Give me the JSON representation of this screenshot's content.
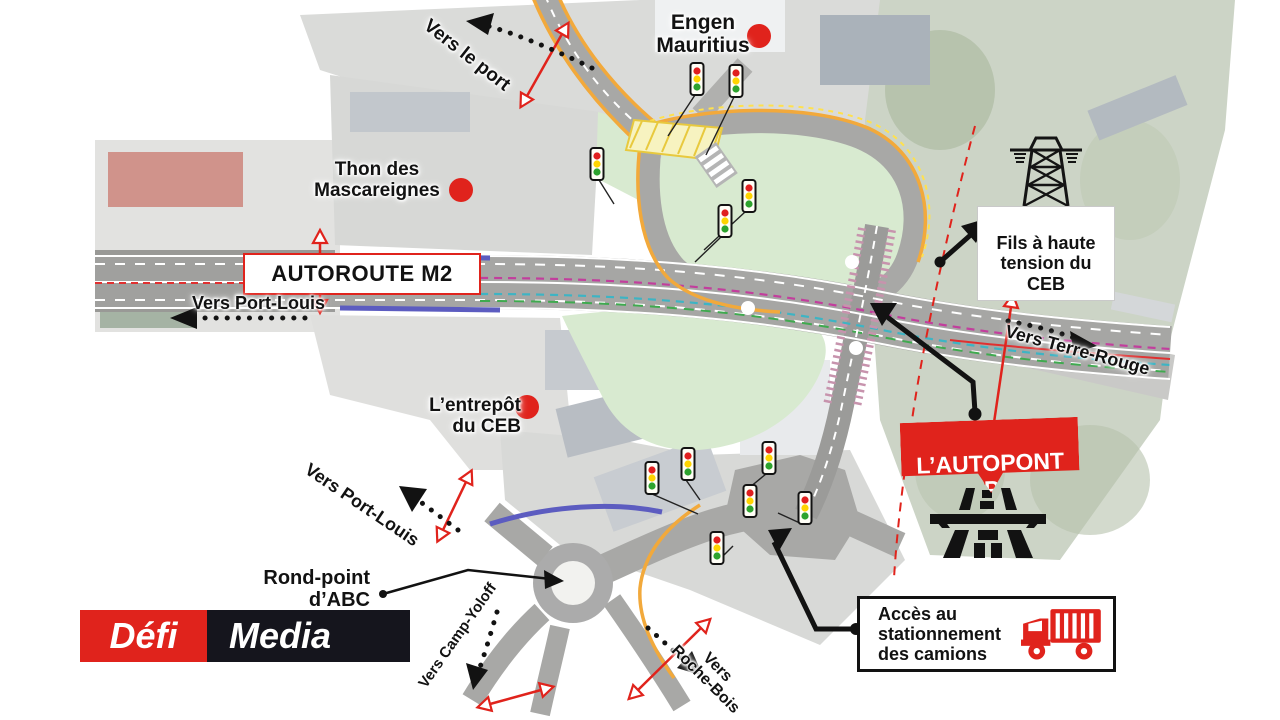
{
  "title": "Infographie de l'autopont proposé (échangeur autoroute M2)",
  "colors": {
    "accent_red": "#e0231c",
    "logo_dark": "#15151d",
    "road_gray": "#a6a6a4",
    "green_area": "#d8ead0",
    "orange_edge": "#f2a93b",
    "blue_edge": "#5c5cc0"
  },
  "labels": {
    "engen": "Engen\nMauritius",
    "vers_le_port": "Vers le port",
    "thon": "Thon des\nMascareignes",
    "autoroute_m2": "AUTOROUTE M2",
    "vers_port_louis_upper": "Vers Port-Louis",
    "fils_haute_tension": "Fils à haute\ntension du\nCEB",
    "vers_terre_rouge": "Vers Terre-Rouge",
    "entrepot_ceb": "L’entrepôt\ndu CEB",
    "autopont": "L’AUTOPONT\nPROPOSÉ",
    "vers_port_louis_lower": "Vers Port-Louis",
    "rond_point": "Rond-point\nd’ABC",
    "camp_yoloff": "Vers Camp-Yoloff",
    "roche_bois": "Vers\nRoche-Bois",
    "acces_stationnement": "Accès au\nstationnement\ndes camions"
  },
  "logo": {
    "defi": "Défi",
    "media": "Media"
  },
  "icons": {
    "location_dot": "red filled circle marker",
    "traffic_light": "red-yellow-green traffic light",
    "power_pylon": "high-voltage transmission tower",
    "flyover": "black flyover/overpass pictogram",
    "truck": "red lorry pictogram",
    "dotted_arrow": "black dotted direction arrow",
    "section_marker": "red line with open triangles"
  }
}
